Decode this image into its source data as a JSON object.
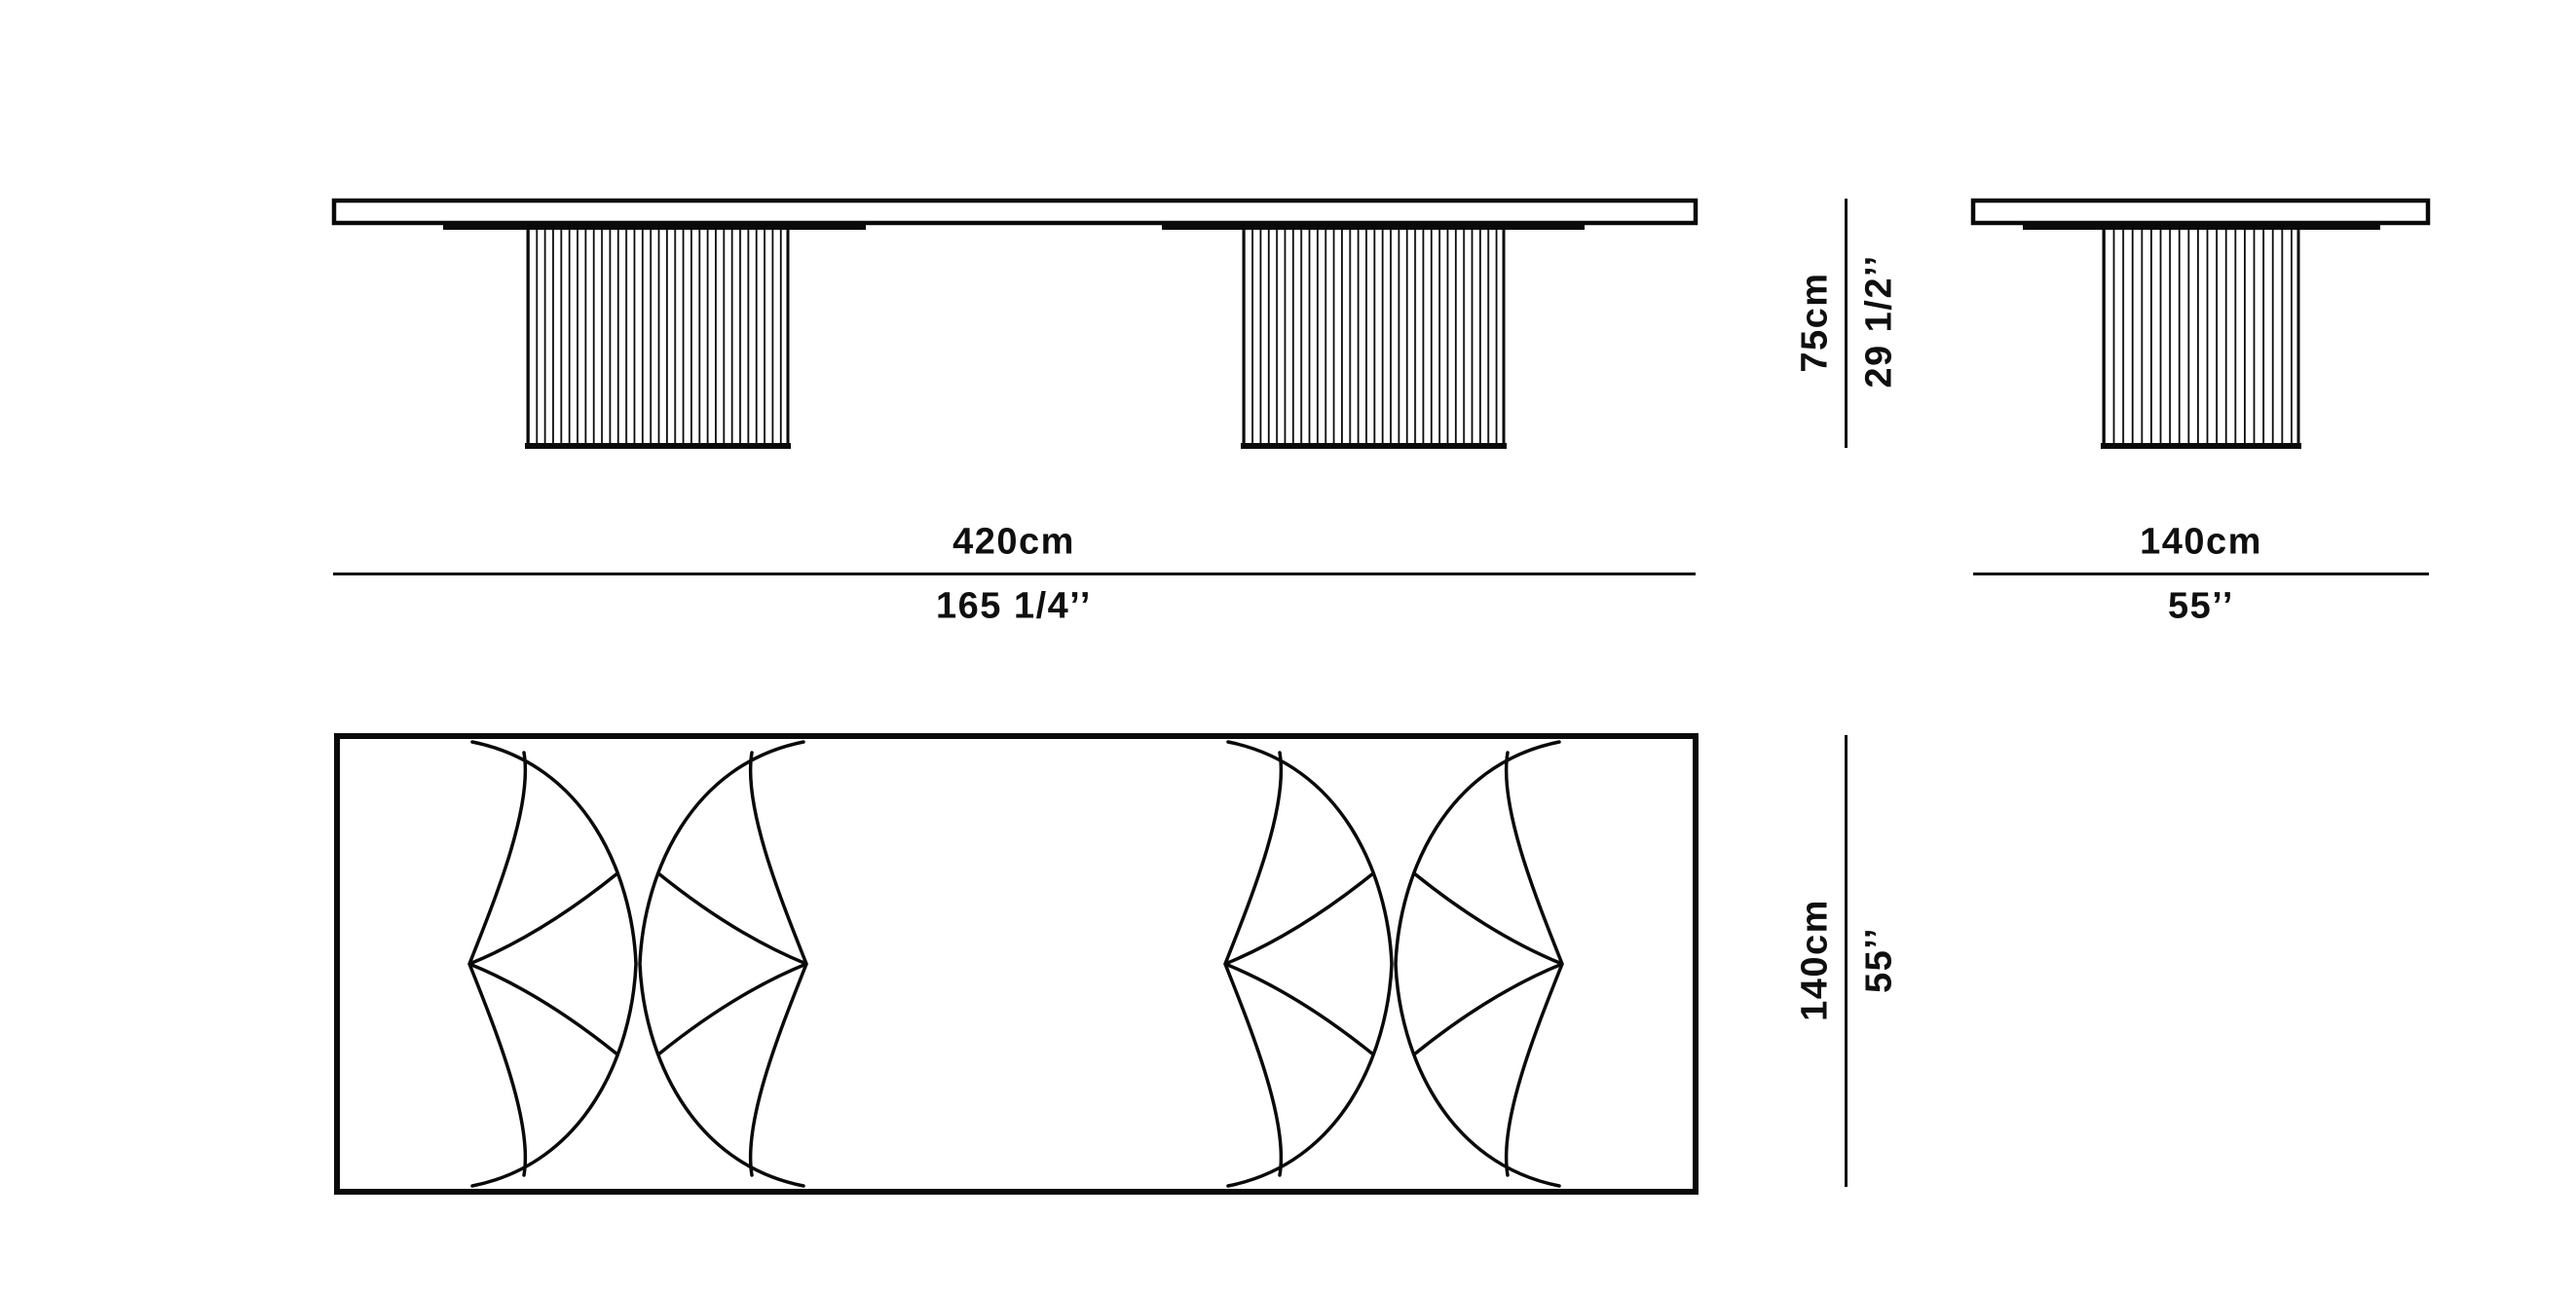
{
  "colors": {
    "background": "#ffffff",
    "ink": "#0a0a0a"
  },
  "drawing": {
    "type": "furniture dimension diagram",
    "views": [
      "front-elevation",
      "side-elevation",
      "plan-view"
    ]
  },
  "dimensions": {
    "length": {
      "metric": "420cm",
      "imperial": "165 1/4’’"
    },
    "height": {
      "metric": "75cm",
      "imperial": "29 1/2’’"
    },
    "width": {
      "metric": "140cm",
      "imperial": "55’’"
    },
    "depth": {
      "metric": "140cm",
      "imperial": "55’’"
    }
  }
}
